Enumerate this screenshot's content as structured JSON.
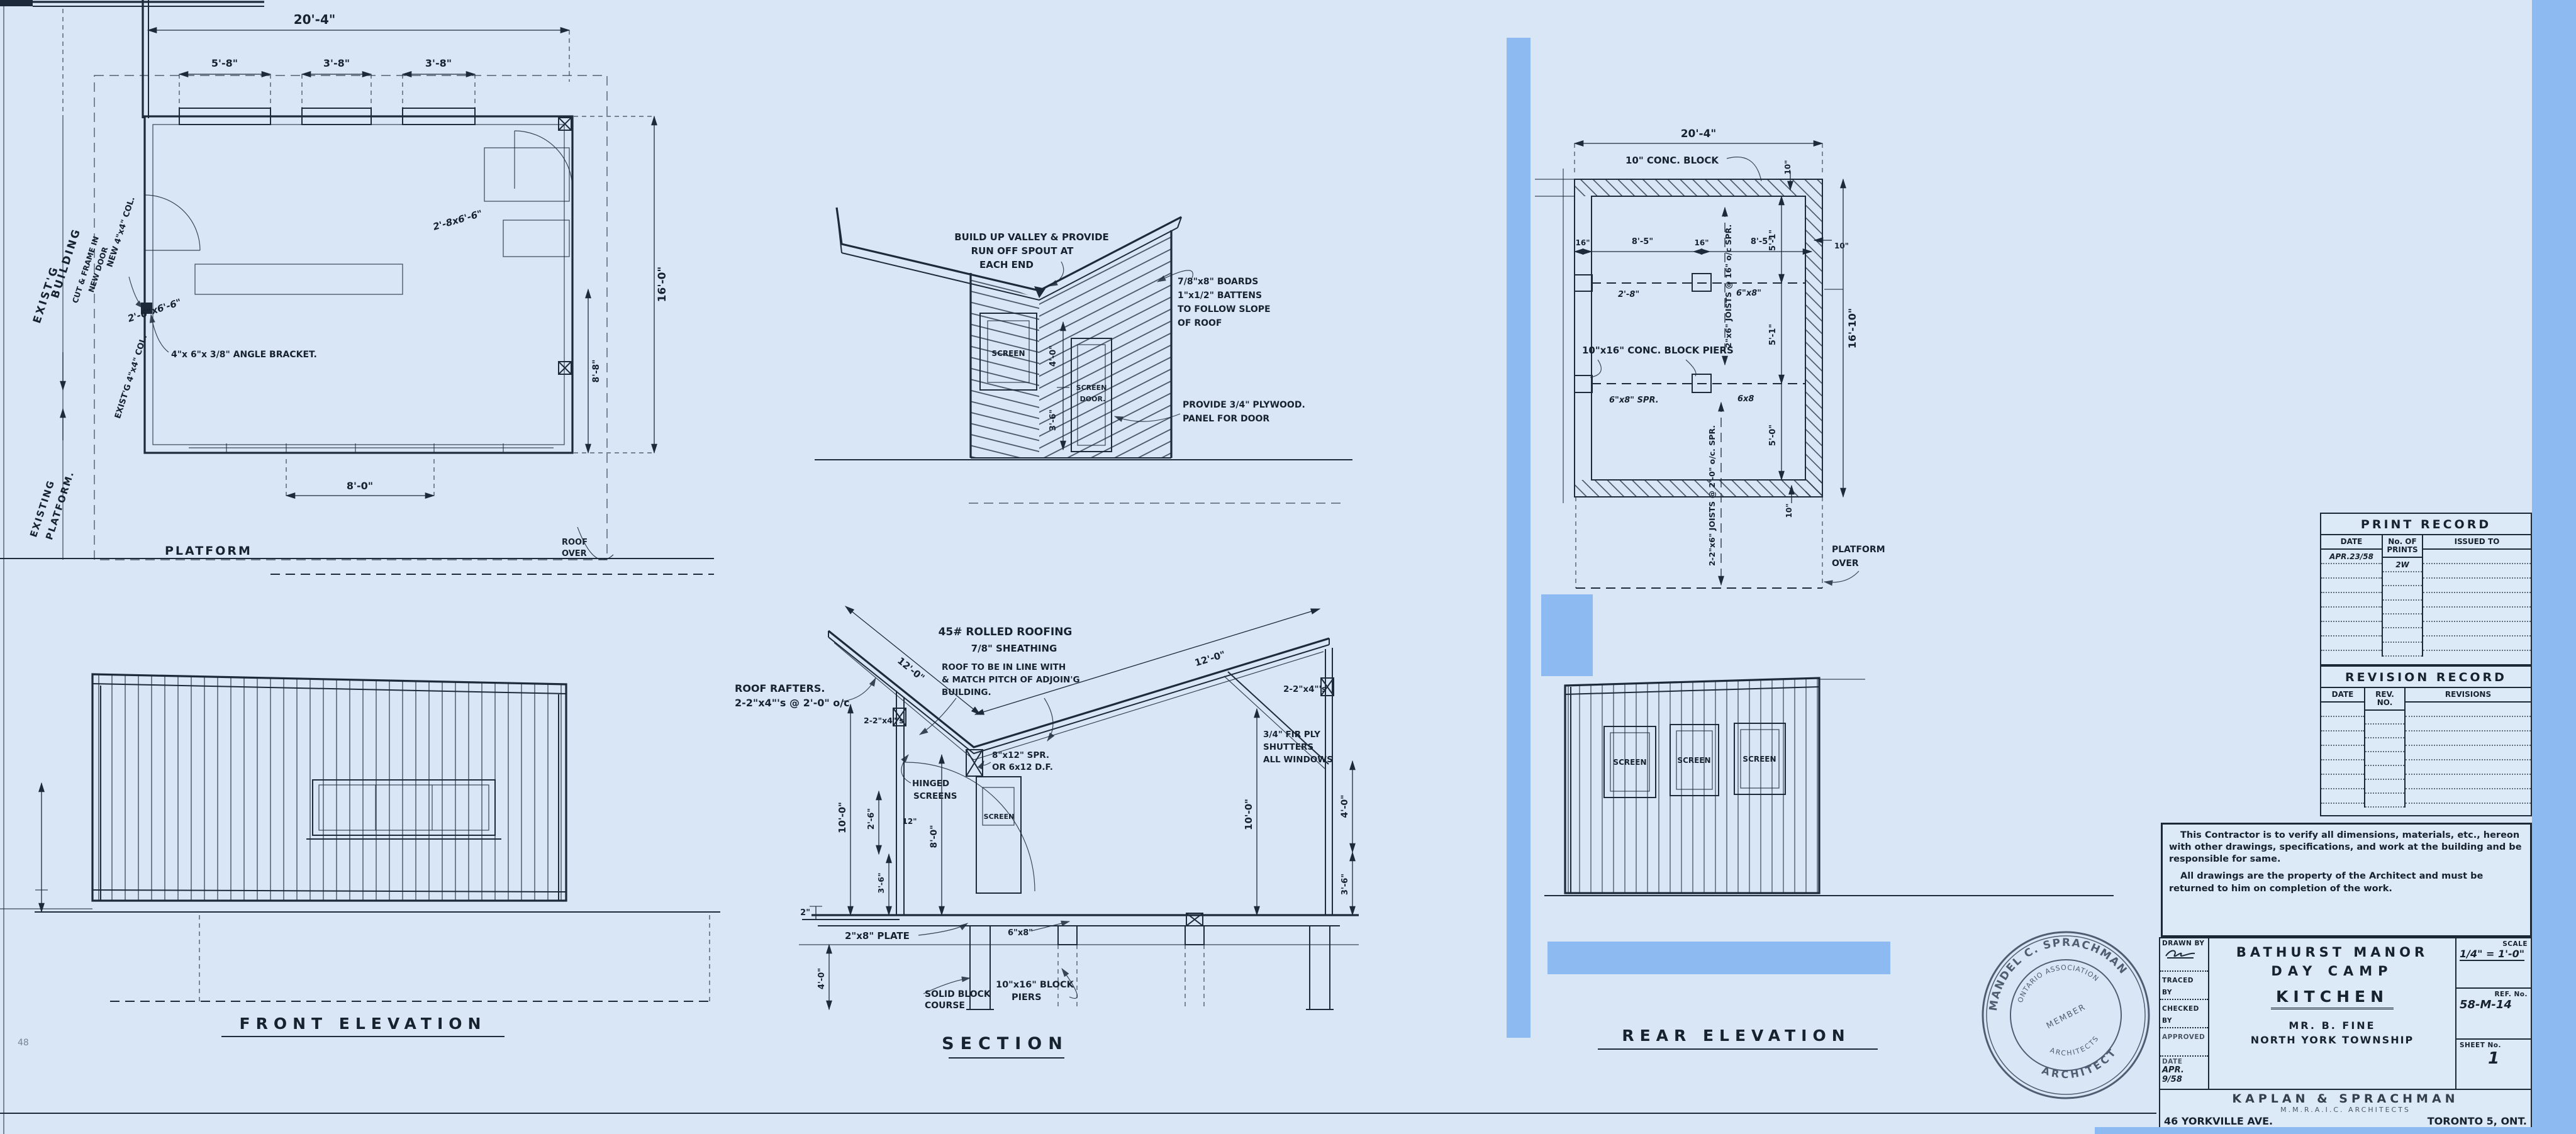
{
  "colors": {
    "paper": "#d8e6f6",
    "ink": "#1c2a3a",
    "overlay": "#8cbaf1"
  },
  "floor_plan": {
    "dim_overall": "20'-4\"",
    "dim_win": [
      "5'-8\"",
      "3'-8\"",
      "3'-8\""
    ],
    "dim_depth": "16'-0\"",
    "dim_inner": "8'-8\"",
    "dim_bottom": "8'-0\"",
    "door_left": "2'-6\"x6'-6\"",
    "door_right": "2'-8x6'-6\"",
    "exist_building": [
      "EXIST'G",
      "BUILDING"
    ],
    "cut_frame": [
      "CUT & FRAME IN",
      "NEW DOOR"
    ],
    "new_col": "NEW 4\"x4\" COL.",
    "exist_col": "EXIST'G 4\"x4\" COL.",
    "angle_bracket": "4\"x 6\"x 3/8\" ANGLE BRACKET.",
    "exist_platform": [
      "EXISTING",
      "PLATFORM."
    ],
    "platform": "PLATFORM",
    "roof_over": [
      "ROOF",
      "OVER"
    ]
  },
  "front_elevation": {
    "title": "FRONT ELEVATION"
  },
  "end_elevation": {
    "valley_note": [
      "BUILD UP VALLEY & PROVIDE",
      "RUN OFF SPOUT AT",
      "EACH END"
    ],
    "boards_note": [
      "7/8\"x8\" BOARDS",
      "1\"x1/2\" BATTENS",
      "TO FOLLOW SLOPE",
      "OF ROOF"
    ],
    "plywood_note": [
      "PROVIDE 3/4\" PLYWOOD.",
      "PANEL FOR DOOR"
    ],
    "screen": "SCREEN",
    "screen_door": [
      "SCREEN",
      "DOOR."
    ],
    "dim_top": "4'-0\"",
    "dim_bottom": "3'-6\""
  },
  "section": {
    "title": "SECTION",
    "roofing": "45# ROLLED ROOFING",
    "sheathing": "7/8\" SHEATHING",
    "rafters": [
      "ROOF RAFTERS.",
      "2-2\"x4\"'s @ 2'-0\" o/c"
    ],
    "inline_note": [
      "ROOF TO BE IN LINE WITH",
      "& MATCH PITCH OF ADJOIN'G",
      "BUILDING."
    ],
    "dim_roof_l": "12'-0\"",
    "dim_roof_r": "12'-0\"",
    "posts_l": "2-2\"x4\"'s",
    "posts_r": "2-2\"x4\"'s",
    "beam": [
      "8\"x12\" SPR.",
      "OR 6x12 D.F."
    ],
    "hinged": [
      "HINGED",
      "SCREENS"
    ],
    "screen": "SCREEN",
    "shutters": [
      "3/4\" FIR PLY",
      "SHUTTERS",
      "ALL WINDOWS"
    ],
    "dim_wall_l": "10'-0\"",
    "dim_26": "2'-6\"",
    "dim_12": "12\"",
    "dim_80": "8'-0\"",
    "dim_36_l": "3'-6\"",
    "dim_2": "2\"",
    "dim_40_l": "4'-0\"",
    "dim_wall_r": "10'-0\"",
    "dim_40_r": "4'-0\"",
    "dim_36_r": "3'-6\"",
    "plate": "2\"x8\" PLATE",
    "solid_block": [
      "SOLID BLOCK",
      "COURSE"
    ],
    "b68": "6\"x8\"",
    "piers": [
      "10\"x16\" BLOCK",
      "PIERS"
    ]
  },
  "foundation": {
    "dim_overall": "20'-4\"",
    "conc_block": "10\" CONC. BLOCK",
    "dim_10": "10\"",
    "dims_x": [
      "16\"",
      "8'-5\"",
      "16\"",
      "8'-5\""
    ],
    "dim_28": "2'-8\"",
    "b68": "6\"x8\"",
    "b68_spr": "6\"x8\" SPR.",
    "b68b": "6x8",
    "dims_y": [
      "5'-1\"",
      "5'-1\"",
      "5'-0\""
    ],
    "dim_depth": "16'-10\"",
    "joists1": "2\"x6\" JOISTS @ 16\" o/c SPR.",
    "joists2": "2-2\"x6\" JOISTS @ 2'-0\" o/c. SPR.",
    "piers": "10\"x16\" CONC. BLOCK PIERS",
    "platform_over": [
      "PLATFORM",
      "OVER"
    ]
  },
  "rear_elevation": {
    "title": "REAR ELEVATION",
    "screens": [
      "SCREEN",
      "SCREEN",
      "SCREEN"
    ]
  },
  "print_record": {
    "title": "PRINT RECORD",
    "col_date": "DATE",
    "col_prints": "No. OF\nPRINTS",
    "col_issued": "ISSUED TO",
    "entry_date": "APR.23/58",
    "entry_prints": "2W"
  },
  "revision_record": {
    "title": "REVISION RECORD",
    "col_date": "DATE",
    "col_rev": "REV.\nNO.",
    "col_revisions": "REVISIONS"
  },
  "contractor_note": {
    "p1": "This Contractor is to verify all dimensions, materials, etc., hereon with other drawings, specifications, and work at the building and be responsible for same.",
    "p2": "All drawings are the property of the Architect and must be returned to him on completion of the work."
  },
  "title_block": {
    "drawn_by": "DRAWN BY",
    "traced_by": "TRACED BY",
    "checked_by": "CHECKED BY",
    "approved": "APPROVED",
    "date_label": "DATE",
    "date_value": "APR. 9/58",
    "project1": "BATHURST MANOR",
    "project2": "DAY CAMP",
    "project3": "KITCHEN",
    "client": "MR. B. FINE",
    "township": "NORTH YORK TOWNSHIP",
    "scale_label": "SCALE",
    "scale_value": "1/4\" = 1'-0\"",
    "ref_label": "REF. No.",
    "ref_value": "58-M-14",
    "sheet_label": "SHEET No.",
    "sheet_value": "1",
    "firm": "KAPLAN & SPRACHMAN",
    "firm2": "M.M.R.A.I.C. ARCHITECTS",
    "addr": "46 YORKVILLE AVE.",
    "city": "TORONTO 5, ONT."
  },
  "seal": {
    "name": "MANDEL C. SPRACHMAN",
    "title": "ARCHITECT",
    "assoc1": "ONTARIO ASSOCIATION",
    "assoc2": "ARCHITECTS",
    "member": "MEMBER"
  },
  "corner_mark": "48"
}
